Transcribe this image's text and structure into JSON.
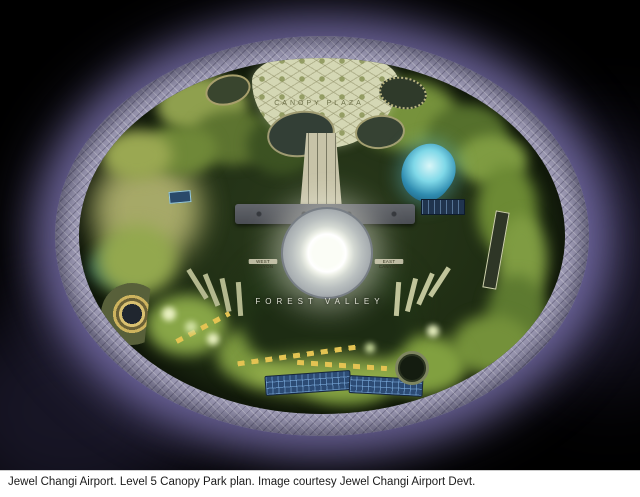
{
  "figure": {
    "caption": "Jewel Changi Airport. Level 5 Canopy Park plan. Image courtesy Jewel Changi Airport Devt.",
    "labels": {
      "canopy_plaza": "CANOPY PLAZA",
      "forest_valley": "FOREST VALLEY",
      "west_canyon": "WEST CANYON",
      "east_canyon": "EAST CANYON"
    },
    "colors": {
      "background": "#000000",
      "halo_purple": "#8076b4",
      "facade_ring": "#a29fb9",
      "park_dark_green": "#1f2d13",
      "tree_green": "#6d8c36",
      "lawn_yellow": "#c9c87e",
      "plaza_pale": "#d4d7b4",
      "vortex_glow": "#ffffff",
      "pond_teal": "#49b8d6",
      "panel_blue": "#2c4b74",
      "caption_bg": "#ffffff",
      "caption_text": "#1a1a1a"
    }
  }
}
